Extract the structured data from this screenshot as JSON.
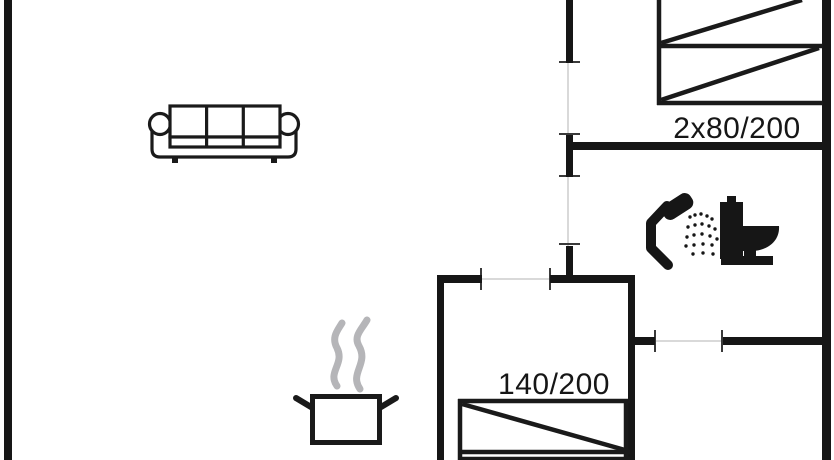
{
  "page": {
    "background_color": "#ffffff",
    "wall_color": "#161616",
    "line_color": "#1a1a1a",
    "steam_color": "#b5b5b8",
    "threshold_color": "#d9d9d9",
    "jamb_color": "#3a3a3a"
  },
  "floorplan": {
    "bed_labels": {
      "double_bed": "2x80/200",
      "small_double_bed": "140/200"
    }
  }
}
